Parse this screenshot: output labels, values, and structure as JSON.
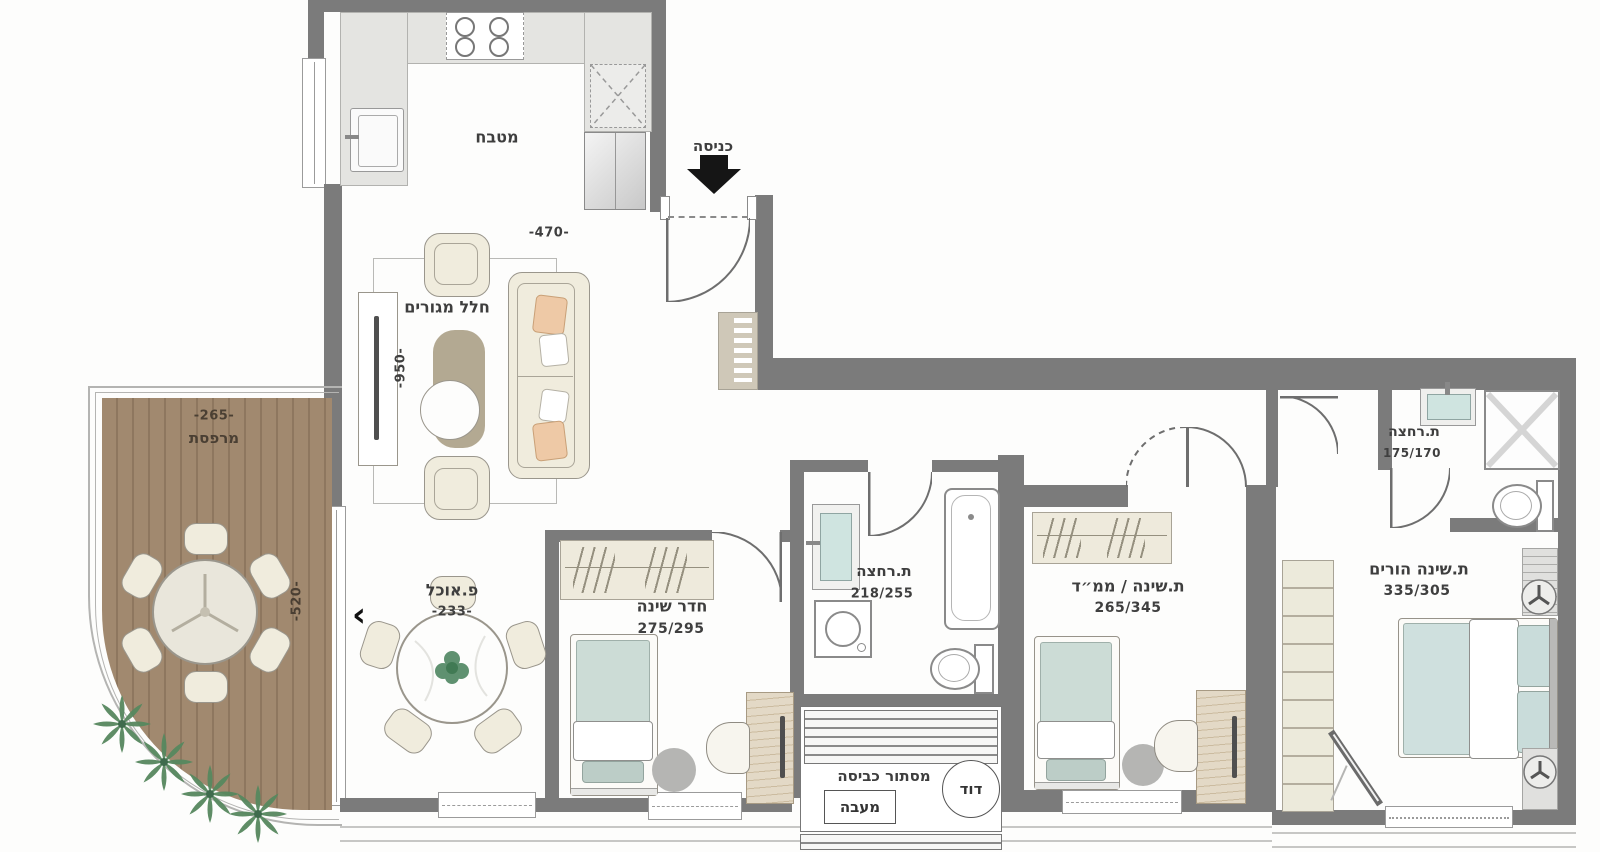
{
  "entrance": {
    "label": "כניסה"
  },
  "rooms": {
    "kitchen": {
      "label": "מטבח",
      "width_dim": "-470-"
    },
    "living": {
      "label": "חלל מגורים",
      "height_dim": "-950-"
    },
    "dining": {
      "label": "פ.אוכל",
      "dim": "-233-"
    },
    "balcony": {
      "label": "מרפסת",
      "width_dim": "-265-",
      "height_dim": "-520-"
    },
    "bedroom": {
      "label": "חדר שינה",
      "dim": "275/295"
    },
    "bathroom": {
      "label": "ת.רחצה",
      "dim": "218/255"
    },
    "mamad": {
      "label": "ת.שינה / ממ״ד",
      "dim": "265/345"
    },
    "parents": {
      "label": "ת.שינה הורים",
      "dim": "335/305"
    },
    "ensuite": {
      "label": "ת.רחצה",
      "dim": "175/170"
    },
    "laundry": {
      "label": "מסתור כביסה",
      "condenser": "מעבה",
      "boiler": "דוד"
    }
  },
  "misc": {
    "slide_arrow": "‹"
  },
  "colors": {
    "wall": "#7b7b7b",
    "deck": "#a1896f",
    "mattress": "#ccdcd6",
    "cream": "#f0ecdd",
    "peach": "#eec9a6",
    "plant": "#57885f"
  }
}
